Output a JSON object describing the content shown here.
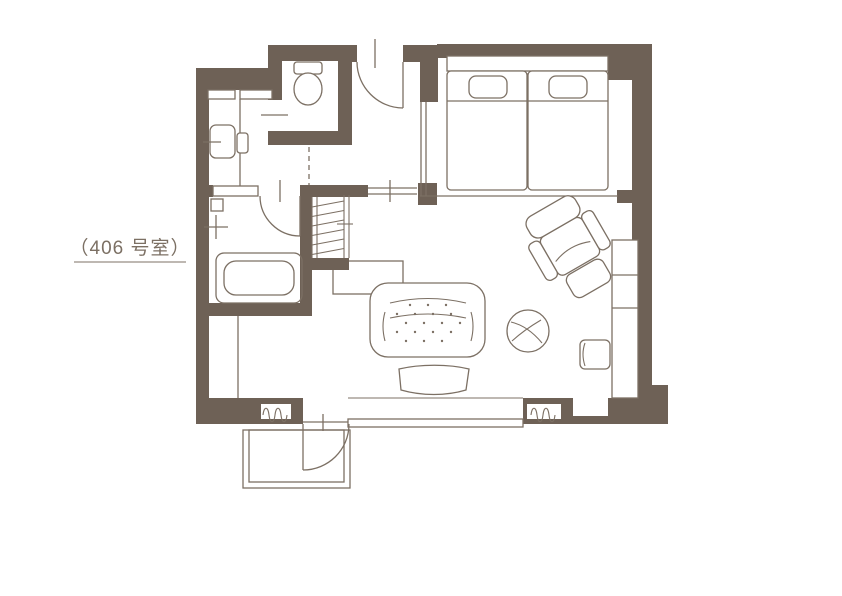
{
  "label": {
    "text": "（406 号室）"
  },
  "colors": {
    "wall": "#6e6156",
    "line": "#7c7064",
    "background": "#ffffff"
  },
  "legend": {
    "floor_plan_of": "hotel guest room",
    "furniture_icons": [
      "toilet-icon",
      "washbasin-icon",
      "shower-mixer-icon",
      "bathtub-icon",
      "closet-hatch-icon",
      "twin-bed-icon",
      "pillow-icon",
      "sofa-icon",
      "ottoman-icon",
      "recliner-chair-icon",
      "round-table-icon",
      "stool-icon",
      "console-desk-icon",
      "curtain-coil-icon",
      "door-swing-icon",
      "window-icon"
    ]
  }
}
